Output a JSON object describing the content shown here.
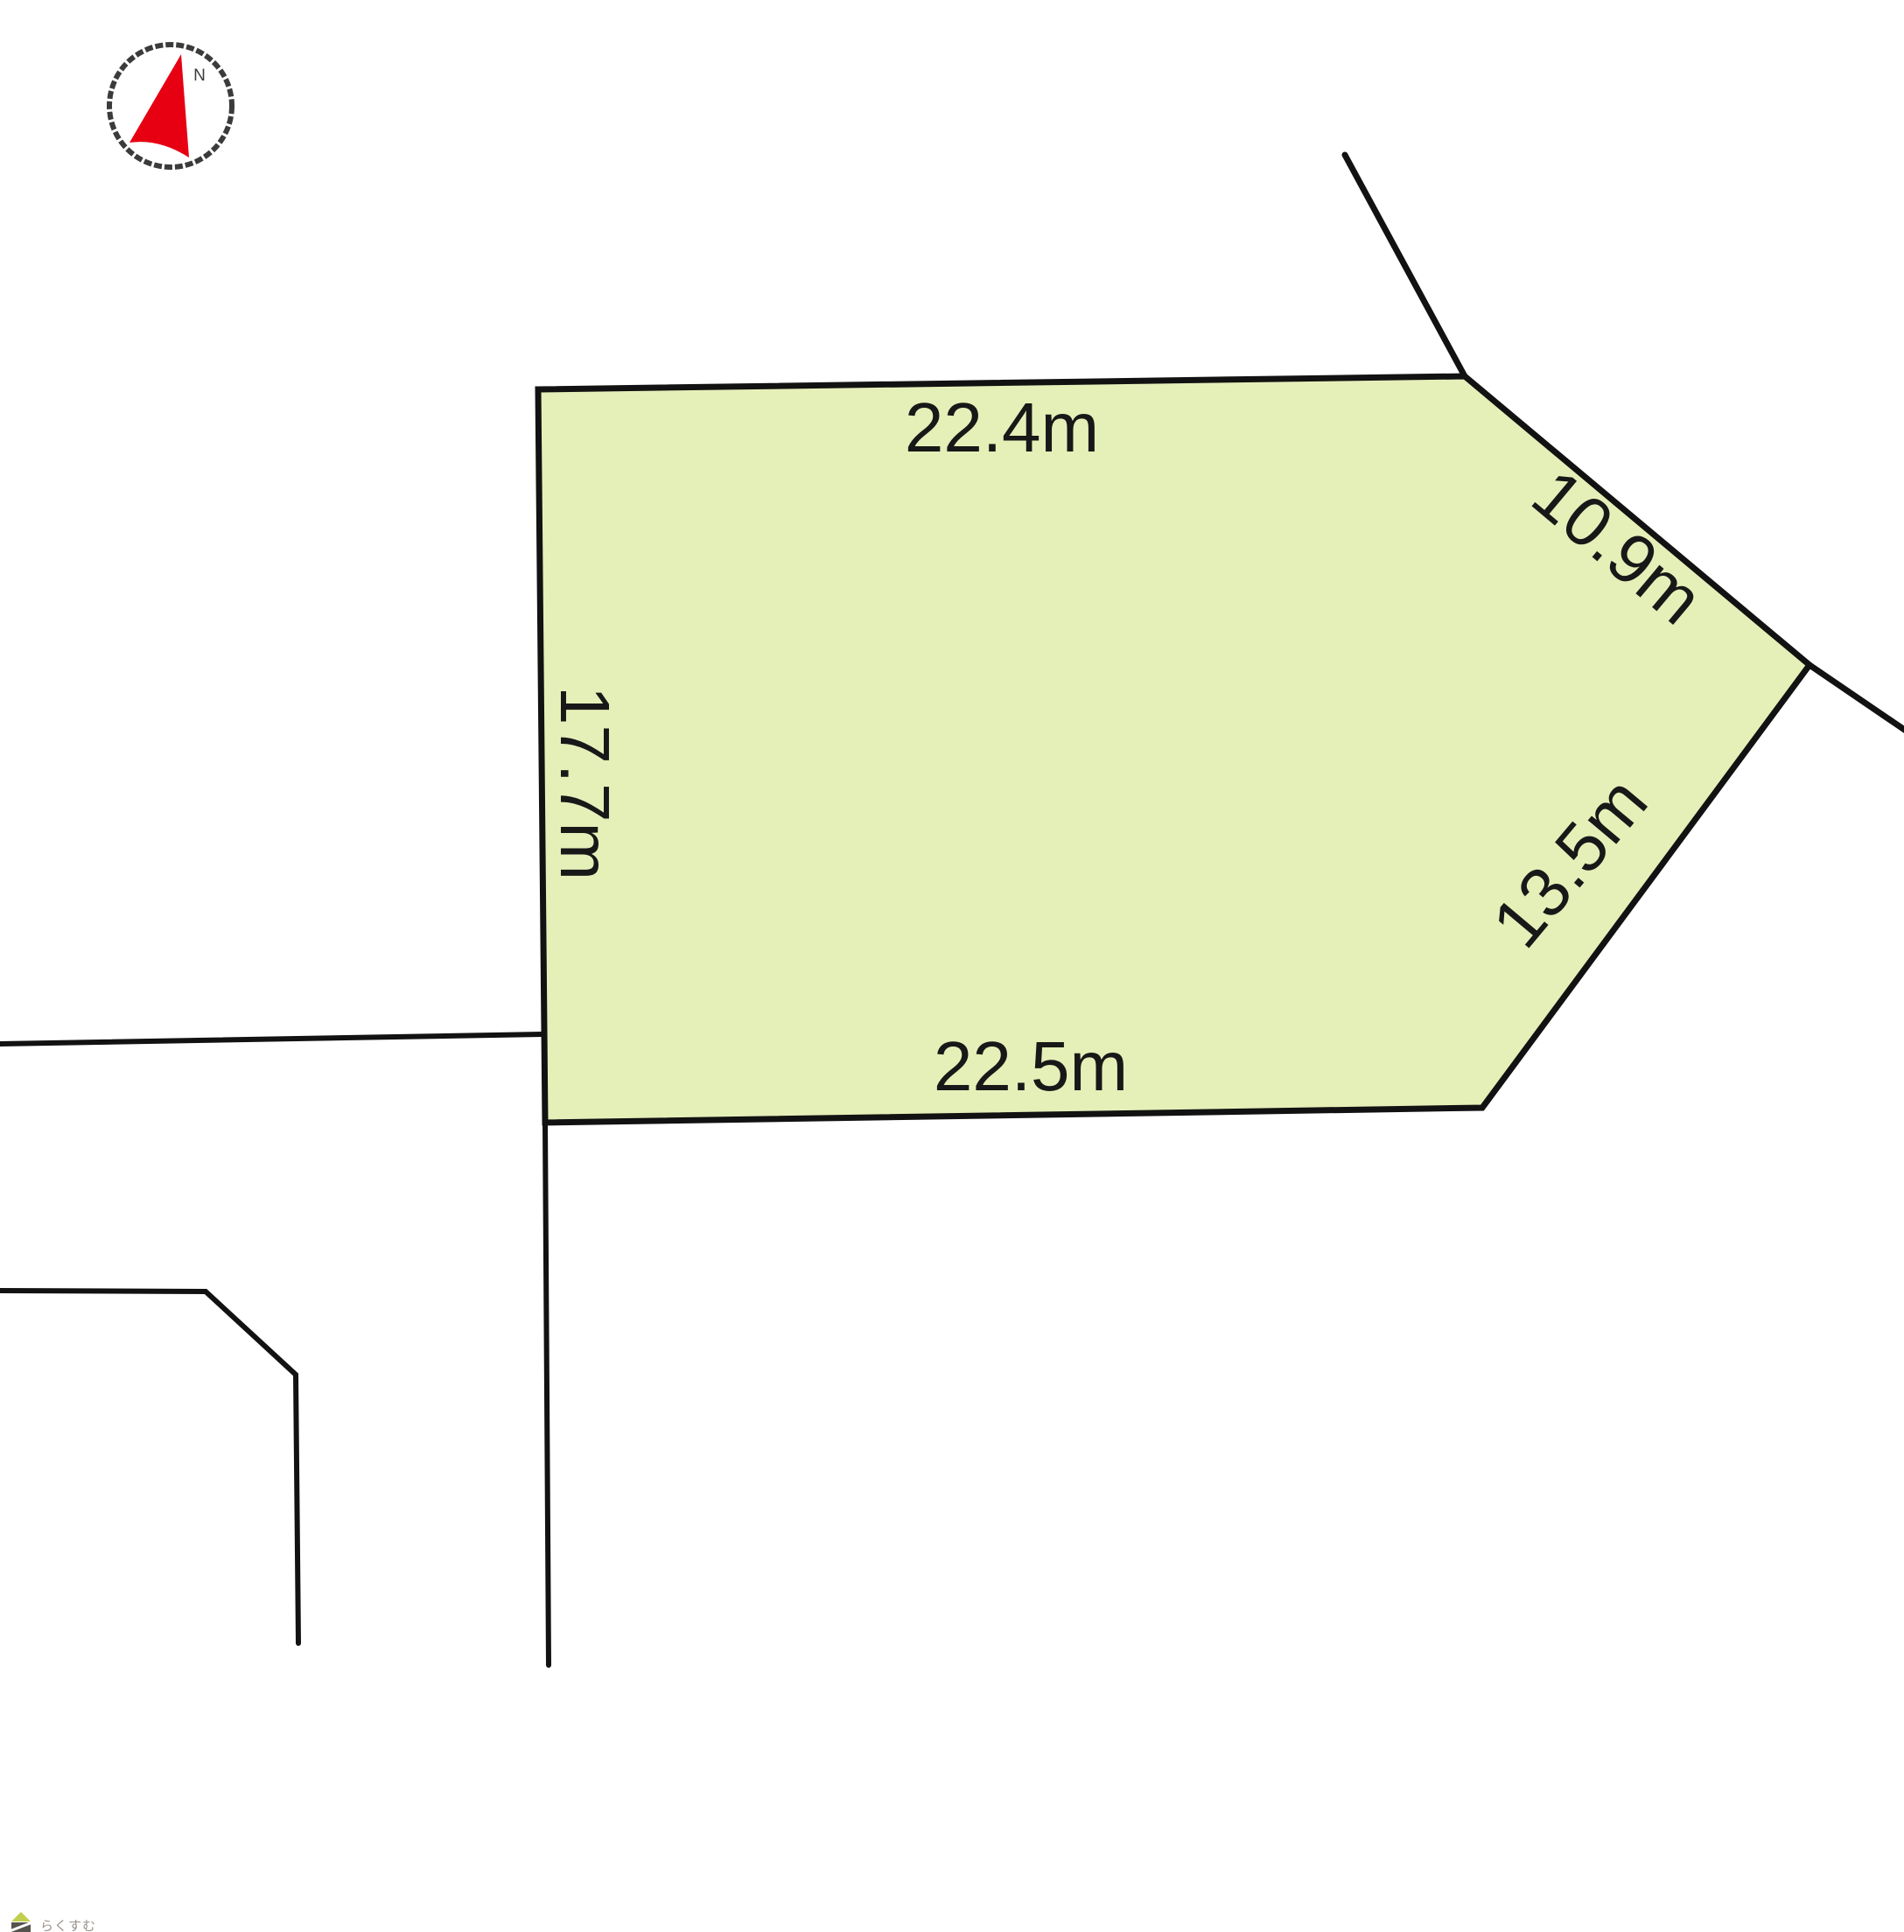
{
  "diagram": {
    "kind": "land-plot-site-plan",
    "background_color": "#ffffff",
    "boundary_line_color": "#121212",
    "plot": {
      "fill_color": "#e5efb8",
      "dimension_labels": {
        "top": "22.4m",
        "left": "17.7m",
        "upper_right": "10.9m",
        "lower_right": "13.5m",
        "bottom": "22.5m"
      }
    },
    "compass": {
      "north_label": "N",
      "arrow_color": "#e60012",
      "ring_color": "#3b3b3b"
    },
    "watermark": {
      "text": "らくすむ",
      "text_color": "#9a9188",
      "roof_color": "#c2cf4e",
      "body_color": "#56524d"
    }
  }
}
